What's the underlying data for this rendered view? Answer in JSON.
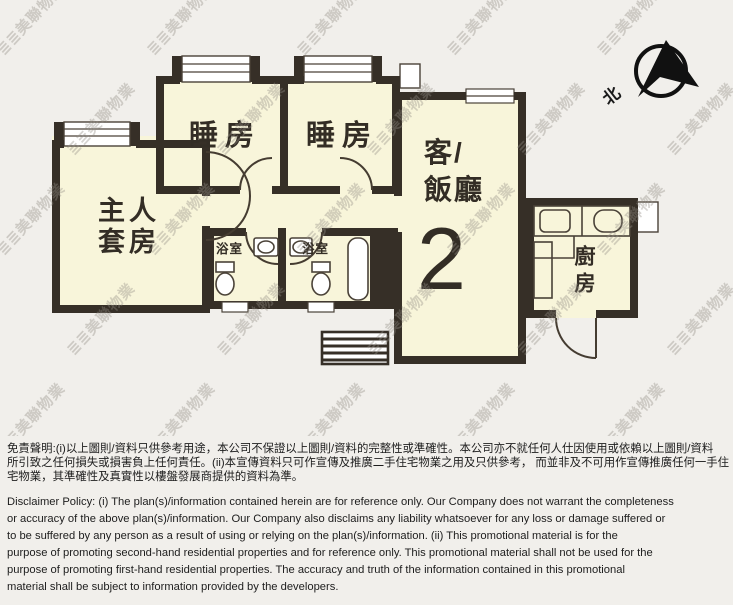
{
  "floor_plan": {
    "unit_number": "2",
    "labels": {
      "master_suite_line1": "主人",
      "master_suite_line2": "套房",
      "bedroom1": "睡房",
      "bedroom2": "睡房",
      "living_dining_line1": "客/",
      "living_dining_line2": "飯廳",
      "bathroom1": "浴室",
      "bathroom2": "浴室",
      "kitchen": "廚房"
    },
    "compass": {
      "north_label": "北"
    }
  },
  "watermark": {
    "logo_glyph": "≣≣",
    "text": "美聯物業"
  },
  "disclaimer": {
    "chinese_lines": [
      "免責聲明:(i)以上圖則/資料只供參考用途，本公司不保證以上圖則/資料的完整性或準確性。本公司亦不就任何人仕因使用或依賴以上圖則/資料",
      "所引致之任何損失或損害負上任何責任。(ii)本宣傳資料只可作宣傳及推廣二手住宅物業之用及只供參考， 而並非及不可用作宣傳推廣任何一手住",
      "宅物業，其準確性及真實性以樓盤發展商提供的資料為準。"
    ],
    "english_lines": [
      "Disclaimer Policy: (i) The plan(s)/information contained herein are for reference only. Our Company does not warrant the completeness",
      "or accuracy of the above plan(s)/information. Our Company also disclaims any liability whatsoever for any loss or damage suffered or",
      "to be suffered by any person as a result of using or relying on the plan(s)/information. (ii) This promotional material is for the",
      "purpose of promoting second-hand residential properties and for reference only. This promotional material shall not be used for the",
      "purpose of promoting first-hand residential properties. The accuracy and truth of the information contained in this promotional",
      "material shall be subject to information provided by the developers."
    ]
  },
  "colors": {
    "wall": "#362f27",
    "floor": "#f8f5da",
    "thin_line": "#4a4238",
    "background": "#f1efeb",
    "text_dark": "#332d25"
  }
}
